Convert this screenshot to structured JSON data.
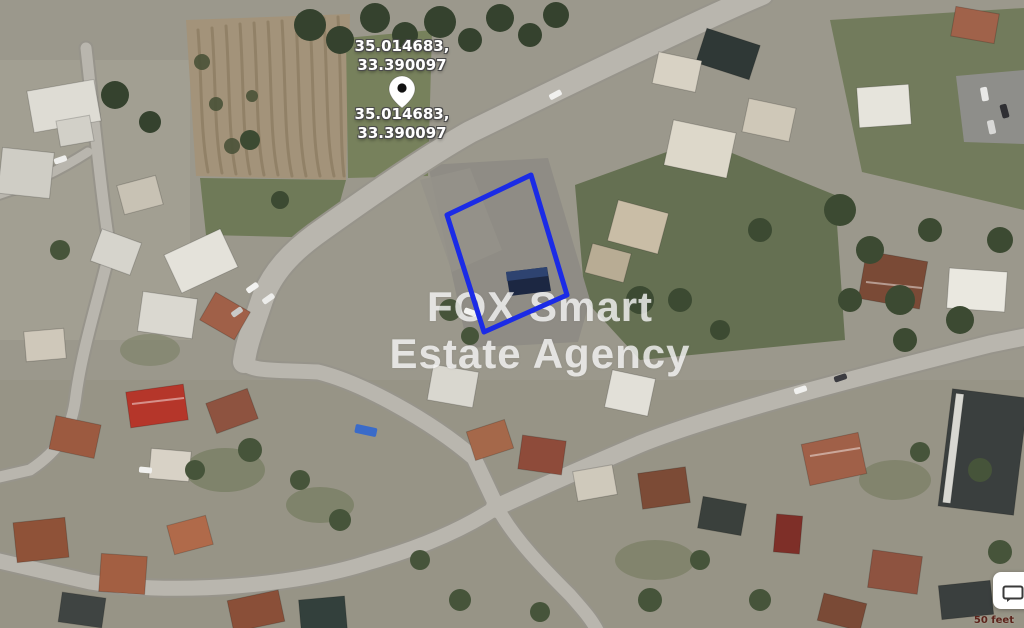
{
  "map": {
    "type": "satellite-imagery",
    "scale_label": "50 feet"
  },
  "marker": {
    "icon": "map-pin-icon",
    "label_above": {
      "line1": "35.014683,",
      "line2": "33.390097"
    },
    "label_below": {
      "line1": "35.014683,",
      "line2": "33.390097"
    }
  },
  "parcel": {
    "points": "531,175 447,215 484,332 567,295",
    "stroke_color": "#1b2be6"
  },
  "watermark": {
    "line1": "FOX Smart",
    "line2": "Estate Agency"
  },
  "feedback_button": {
    "icon": "speech-bubble-icon"
  },
  "colors": {
    "parcel_outline": "#1b2be6",
    "coordinate_text": "#ffffff",
    "watermark_text": "rgba(255,255,255,0.75)",
    "scale_text": "#5c241c"
  }
}
